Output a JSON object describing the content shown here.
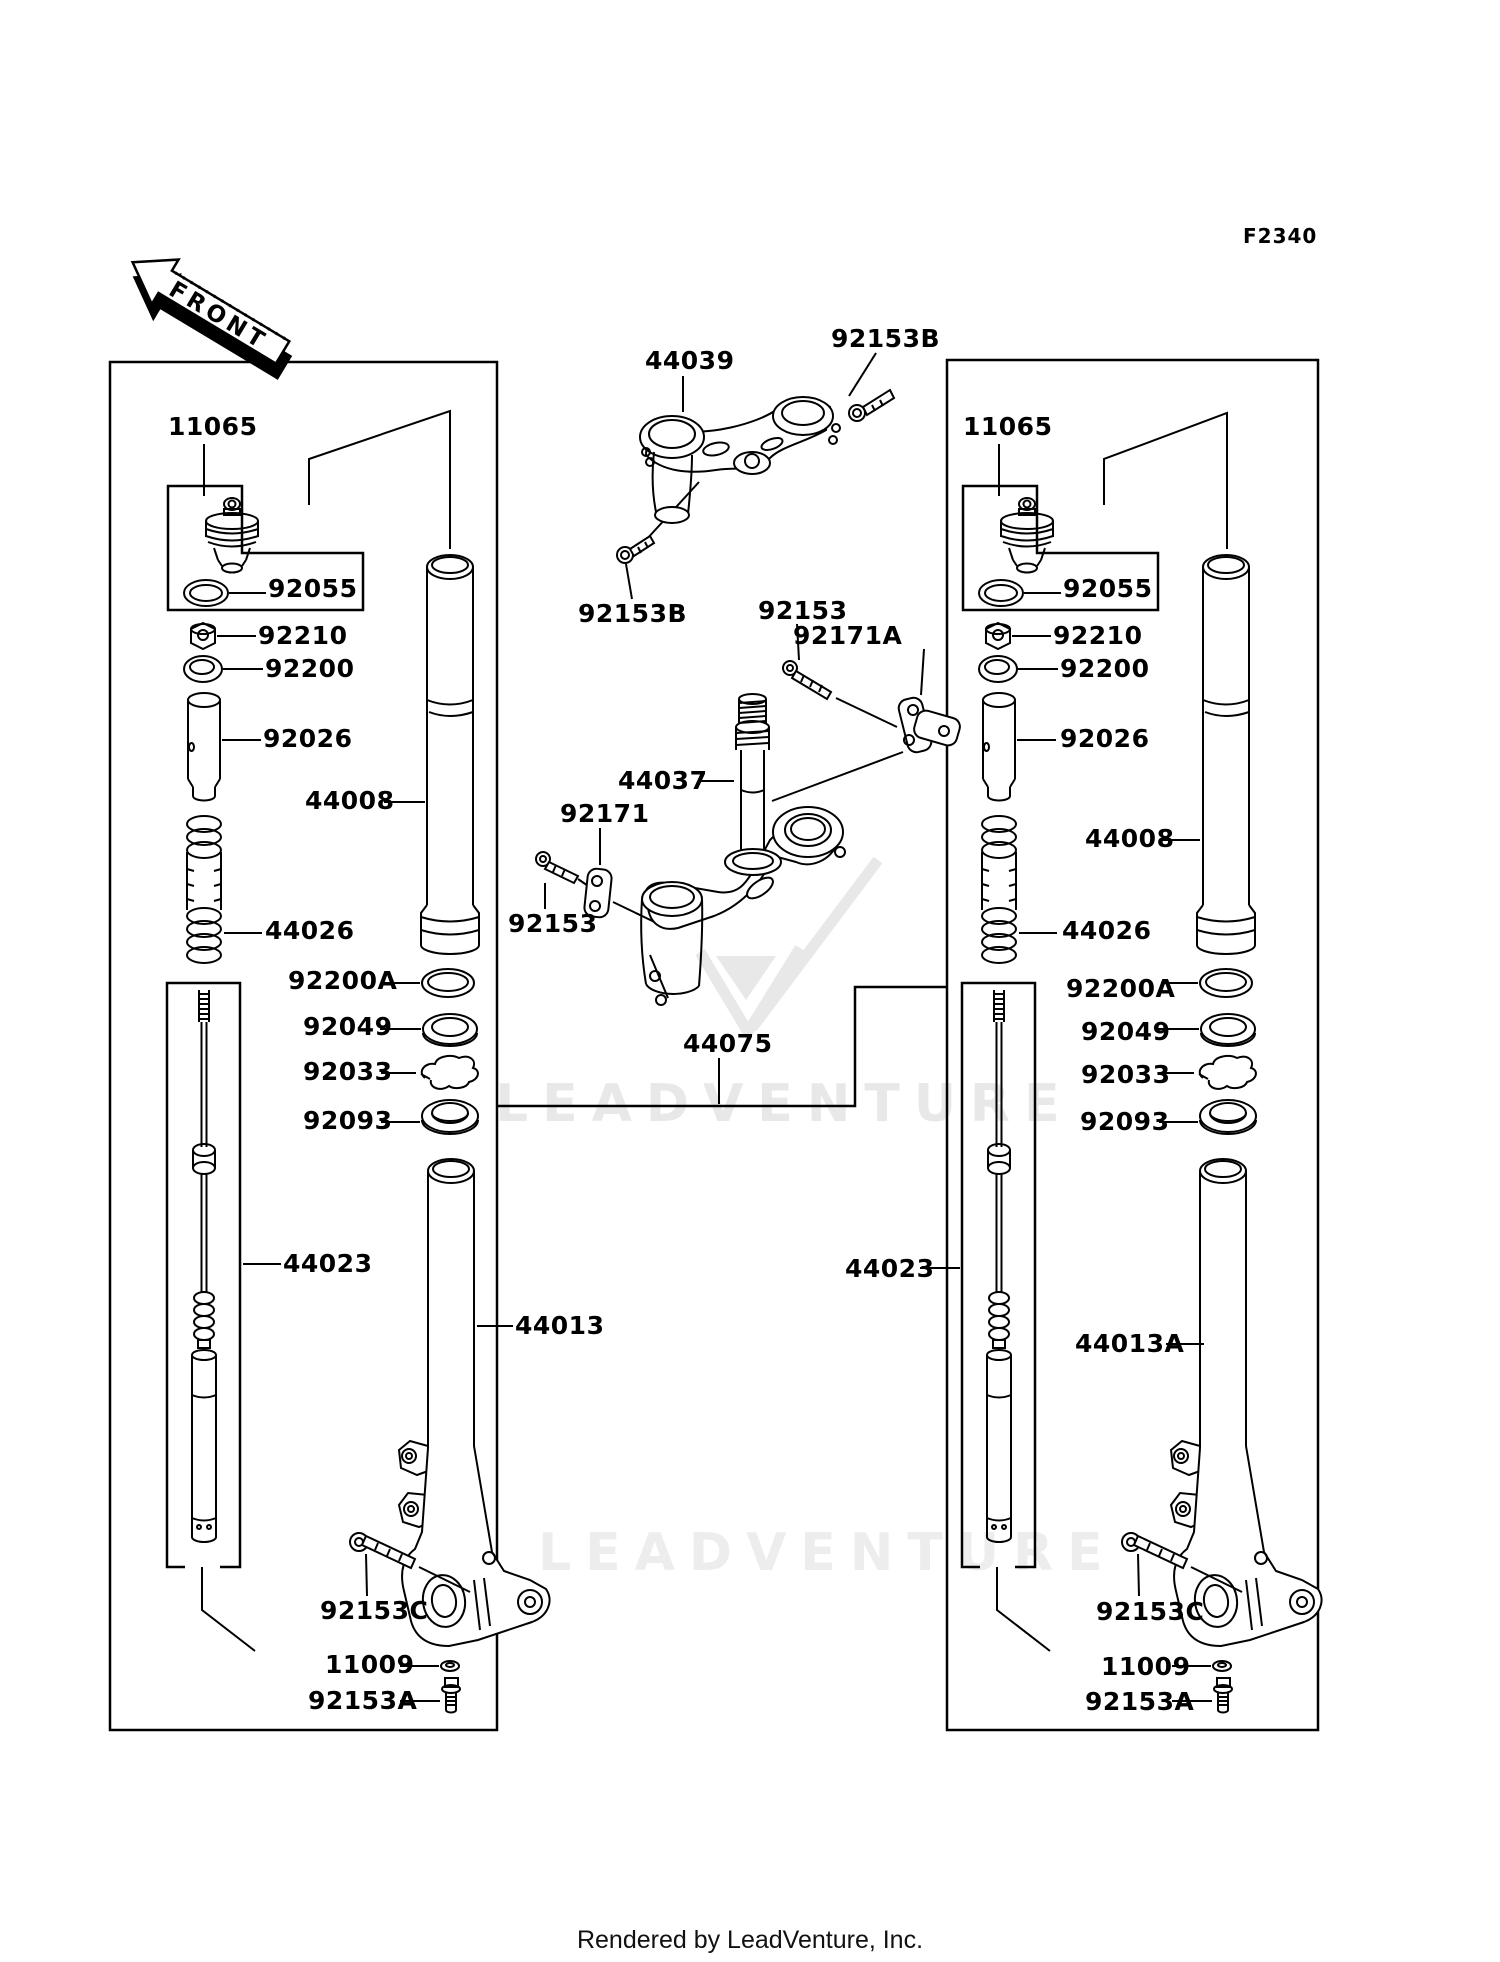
{
  "figure": {
    "code": "F2340"
  },
  "front_arrow": {
    "label": "FRONT"
  },
  "watermark": {
    "line1": "LEADVENTURE",
    "line2": "LEADVENTURE"
  },
  "footer": {
    "credit": "Rendered by LeadVenture, Inc."
  },
  "callouts": [
    {
      "id": "left-11065",
      "text": "11065",
      "x": 168,
      "y": 414
    },
    {
      "id": "left-92055",
      "text": "92055",
      "x": 268,
      "y": 576
    },
    {
      "id": "left-92210",
      "text": "92210",
      "x": 258,
      "y": 623
    },
    {
      "id": "left-92200",
      "text": "92200",
      "x": 265,
      "y": 656
    },
    {
      "id": "left-92026",
      "text": "92026",
      "x": 263,
      "y": 726
    },
    {
      "id": "left-44008",
      "text": "44008",
      "x": 305,
      "y": 788
    },
    {
      "id": "left-44026",
      "text": "44026",
      "x": 265,
      "y": 918
    },
    {
      "id": "left-92200A",
      "text": "92200A",
      "x": 288,
      "y": 968
    },
    {
      "id": "left-92049",
      "text": "92049",
      "x": 303,
      "y": 1014
    },
    {
      "id": "left-92033",
      "text": "92033",
      "x": 303,
      "y": 1059
    },
    {
      "id": "left-92093",
      "text": "92093",
      "x": 303,
      "y": 1108
    },
    {
      "id": "left-44023",
      "text": "44023",
      "x": 283,
      "y": 1251
    },
    {
      "id": "left-44013",
      "text": "44013",
      "x": 515,
      "y": 1313
    },
    {
      "id": "left-92153C",
      "text": "92153C",
      "x": 320,
      "y": 1598
    },
    {
      "id": "left-11009",
      "text": "11009",
      "x": 325,
      "y": 1652
    },
    {
      "id": "left-92153A",
      "text": "92153A",
      "x": 308,
      "y": 1688
    },
    {
      "id": "top-44039",
      "text": "44039",
      "x": 645,
      "y": 348
    },
    {
      "id": "top-92153B",
      "text": "92153B",
      "x": 831,
      "y": 326
    },
    {
      "id": "mid-92153B",
      "text": "92153B",
      "x": 578,
      "y": 601
    },
    {
      "id": "mid-92153-upper",
      "text": "92153",
      "x": 758,
      "y": 598
    },
    {
      "id": "mid-92171A",
      "text": "92171A",
      "x": 793,
      "y": 623
    },
    {
      "id": "mid-44037",
      "text": "44037",
      "x": 618,
      "y": 768
    },
    {
      "id": "mid-92171",
      "text": "92171",
      "x": 560,
      "y": 801
    },
    {
      "id": "mid-92153-lower",
      "text": "92153",
      "x": 508,
      "y": 911
    },
    {
      "id": "mid-44075",
      "text": "44075",
      "x": 683,
      "y": 1031
    },
    {
      "id": "right-11065",
      "text": "11065",
      "x": 963,
      "y": 414
    },
    {
      "id": "right-92055",
      "text": "92055",
      "x": 1063,
      "y": 576
    },
    {
      "id": "right-92210",
      "text": "92210",
      "x": 1053,
      "y": 623
    },
    {
      "id": "right-92200",
      "text": "92200",
      "x": 1060,
      "y": 656
    },
    {
      "id": "right-92026",
      "text": "92026",
      "x": 1060,
      "y": 726
    },
    {
      "id": "right-44008",
      "text": "44008",
      "x": 1085,
      "y": 826
    },
    {
      "id": "right-44026",
      "text": "44026",
      "x": 1062,
      "y": 918
    },
    {
      "id": "right-92200A",
      "text": "92200A",
      "x": 1066,
      "y": 976
    },
    {
      "id": "right-92049",
      "text": "92049",
      "x": 1081,
      "y": 1019
    },
    {
      "id": "right-92033",
      "text": "92033",
      "x": 1081,
      "y": 1062
    },
    {
      "id": "right-92093",
      "text": "92093",
      "x": 1080,
      "y": 1109
    },
    {
      "id": "right-44023",
      "text": "44023",
      "x": 845,
      "y": 1256
    },
    {
      "id": "right-44013A",
      "text": "44013A",
      "x": 1075,
      "y": 1331
    },
    {
      "id": "right-92153C",
      "text": "92153C",
      "x": 1096,
      "y": 1599
    },
    {
      "id": "right-11009",
      "text": "11009",
      "x": 1101,
      "y": 1654
    },
    {
      "id": "right-92153A",
      "text": "92153A",
      "x": 1085,
      "y": 1689
    }
  ]
}
